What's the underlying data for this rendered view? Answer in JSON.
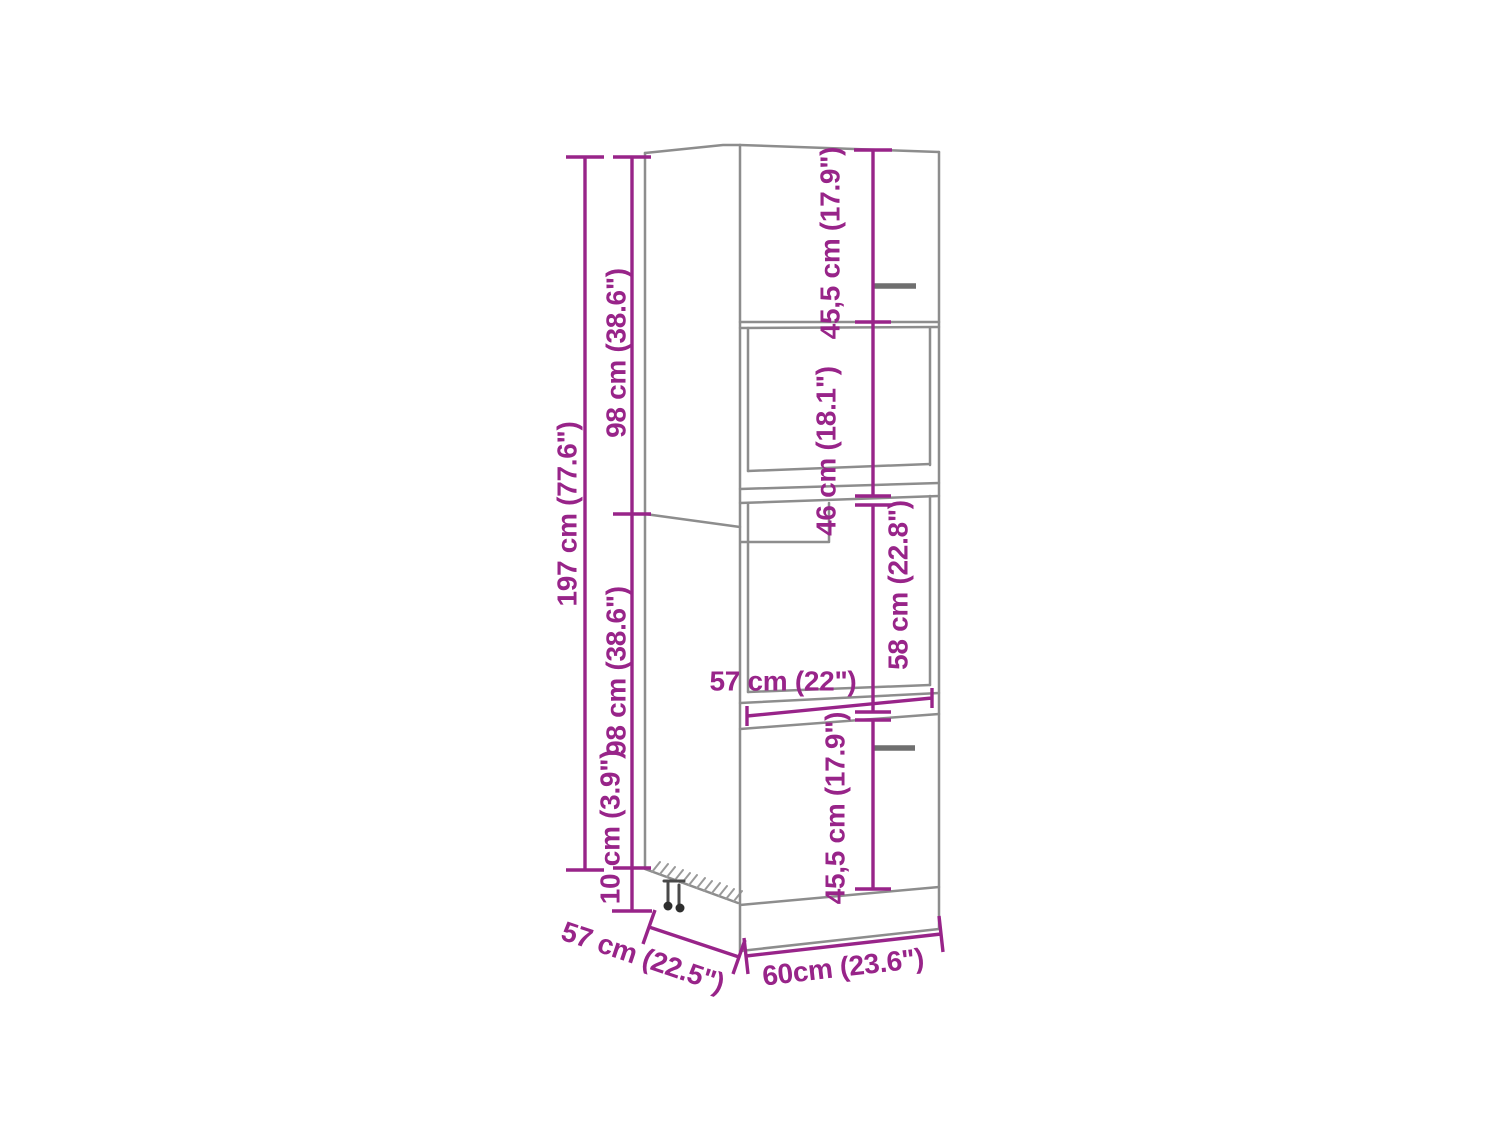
{
  "diagram_type": "furniture-dimension-diagram",
  "colors": {
    "dimension_annotation": "#982489",
    "drawing_outline": "#8d8d8d",
    "handle": "#6f6f6f",
    "background": "#ffffff"
  },
  "dimensions": {
    "total_height": "197 cm (77.6\")",
    "upper_module_height": "98 cm (38.6\")",
    "lower_module_height": "98 cm (38.6\")",
    "plinth_height": "10 cm (3.9\")",
    "top_door_height": "45,5 cm (17.9\")",
    "middle_niche_height": "46 cm (18.1\")",
    "oven_niche_height": "58 cm (22.8\")",
    "niche_inner_width": "57 cm (22\")",
    "bottom_door_height": "45,5 cm (17.9\")",
    "depth": "57 cm (22.5\")",
    "width": "60cm (23.6\")"
  }
}
